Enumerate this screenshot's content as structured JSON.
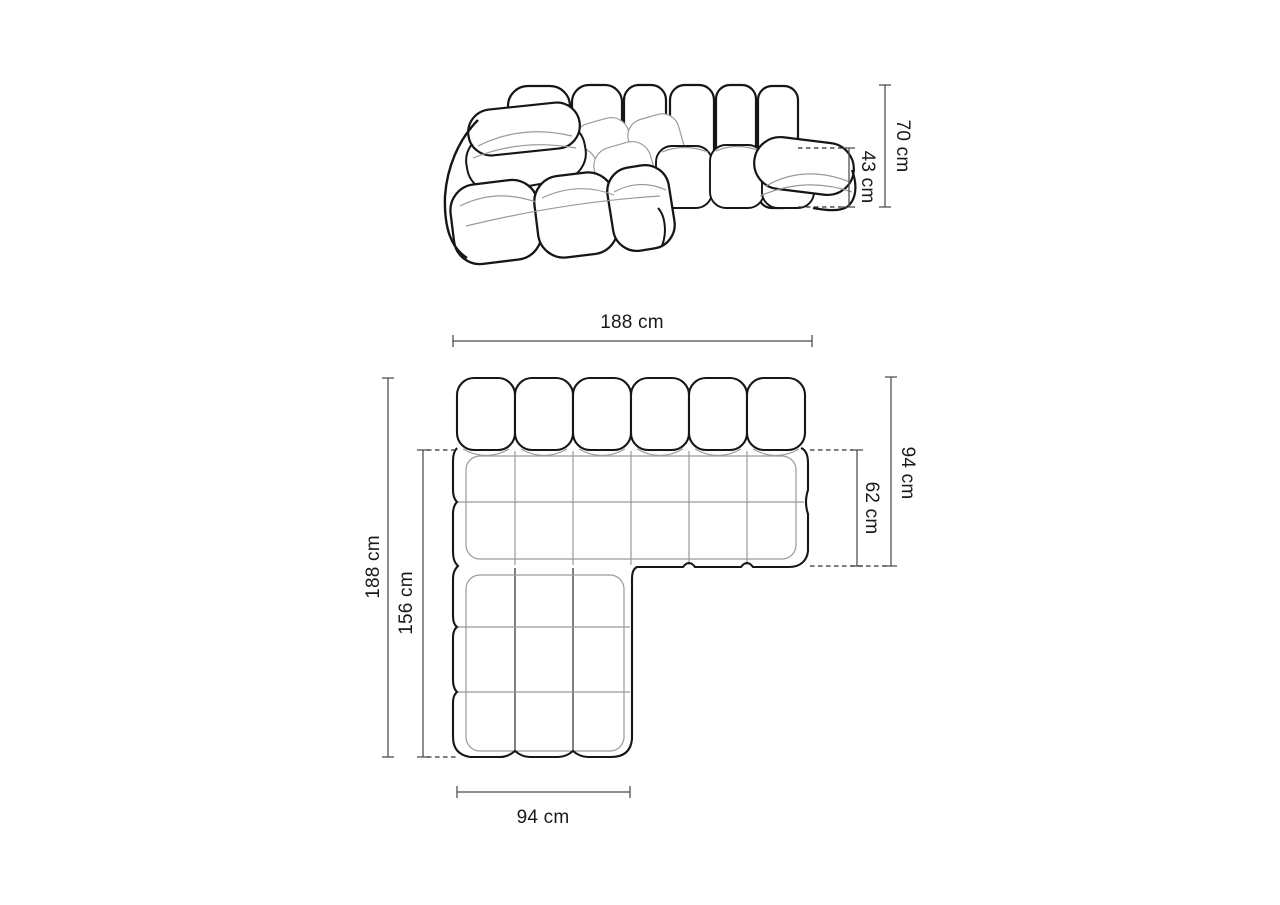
{
  "page": {
    "background": "#ffffff",
    "description": "Modular corner sofa dimension diagram with perspective view and top view"
  },
  "colors": {
    "background": "#ffffff",
    "outline": "#161616",
    "seam": "#9a9a9a",
    "dim": "#4a4a4a",
    "dash": "#2f2f2f",
    "label": "#1a1a1a"
  },
  "views": {
    "side": {
      "name": "perspective view",
      "dims": {
        "height": "70 cm",
        "seat_height": "43 cm"
      }
    },
    "top": {
      "name": "top view",
      "dims": {
        "width": "188 cm",
        "depth": "94 cm",
        "seat_depth": "62 cm",
        "length": "188 cm",
        "chaise_length": "156 cm",
        "chaise_width": "94 cm"
      }
    }
  }
}
